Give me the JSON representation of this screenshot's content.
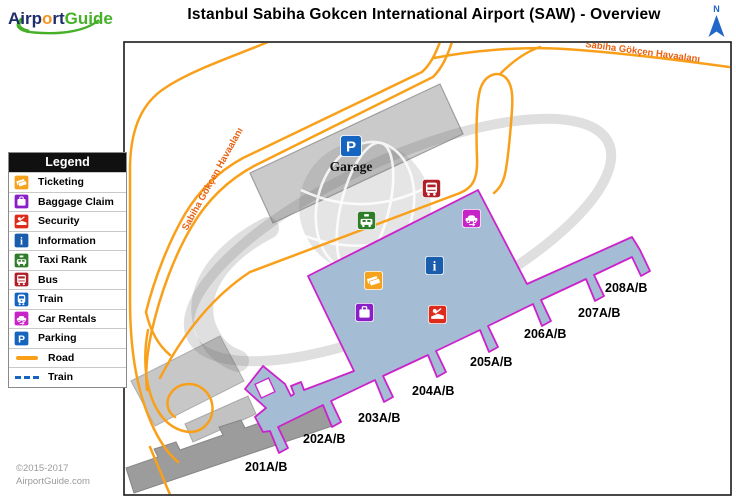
{
  "header": {
    "logo": {
      "p1": "Airp",
      "p2": "o",
      "p3": "rt",
      "p4": "Guide"
    },
    "title": "Istanbul Sabiha Gokcen International Airport (SAW) - Overview",
    "north_label": "N"
  },
  "legend": {
    "title": "Legend",
    "items": [
      {
        "label": "Ticketing",
        "icon": "ticketing-icon",
        "color": "#F5A31E"
      },
      {
        "label": "Baggage Claim",
        "icon": "baggage-claim-icon",
        "color": "#8A1FC8"
      },
      {
        "label": "Security",
        "icon": "security-icon",
        "color": "#DD2C1C"
      },
      {
        "label": "Information",
        "icon": "information-icon",
        "color": "#1A5DAD"
      },
      {
        "label": "Taxi Rank",
        "icon": "taxi-icon",
        "color": "#2F7D2B"
      },
      {
        "label": "Bus",
        "icon": "bus-icon",
        "color": "#B01E28"
      },
      {
        "label": "Train",
        "icon": "train-icon",
        "color": "#1565C0"
      },
      {
        "label": "Car Rentals",
        "icon": "car-rentals-icon",
        "color": "#C724C7"
      },
      {
        "label": "Parking",
        "icon": "parking-icon",
        "color": "#1565C0"
      }
    ],
    "line_items": [
      {
        "label": "Road",
        "type": "road-line",
        "color": "#F9A01B"
      },
      {
        "label": "Train",
        "type": "train-line",
        "color": "#1565C0"
      }
    ]
  },
  "map": {
    "garage_label": "Garage",
    "road_label_diagonal": "Sabiha Gökçen Havaalanı",
    "road_label_top": "Sabiha Gökçen Havaalanı",
    "gates": [
      "201A/B",
      "202A/B",
      "203A/B",
      "204A/B",
      "205A/B",
      "206A/B",
      "207A/B",
      "208A/B"
    ],
    "markers": [
      "parking",
      "taxi",
      "bus",
      "car-rentals",
      "information",
      "ticketing",
      "baggage-claim",
      "security"
    ]
  },
  "footer": {
    "copyright": "©2015-2017",
    "site": "AirportGuide.com"
  },
  "colors": {
    "road": "#F9A01B",
    "road_label": "#E8610F",
    "terminal_fill": "#A5BCD5",
    "terminal_outline": "#CC22CC",
    "garage_fill": "#CACACA",
    "old_terminal_fill": "#9C9C9C",
    "north_arrow": "#2166C9"
  }
}
